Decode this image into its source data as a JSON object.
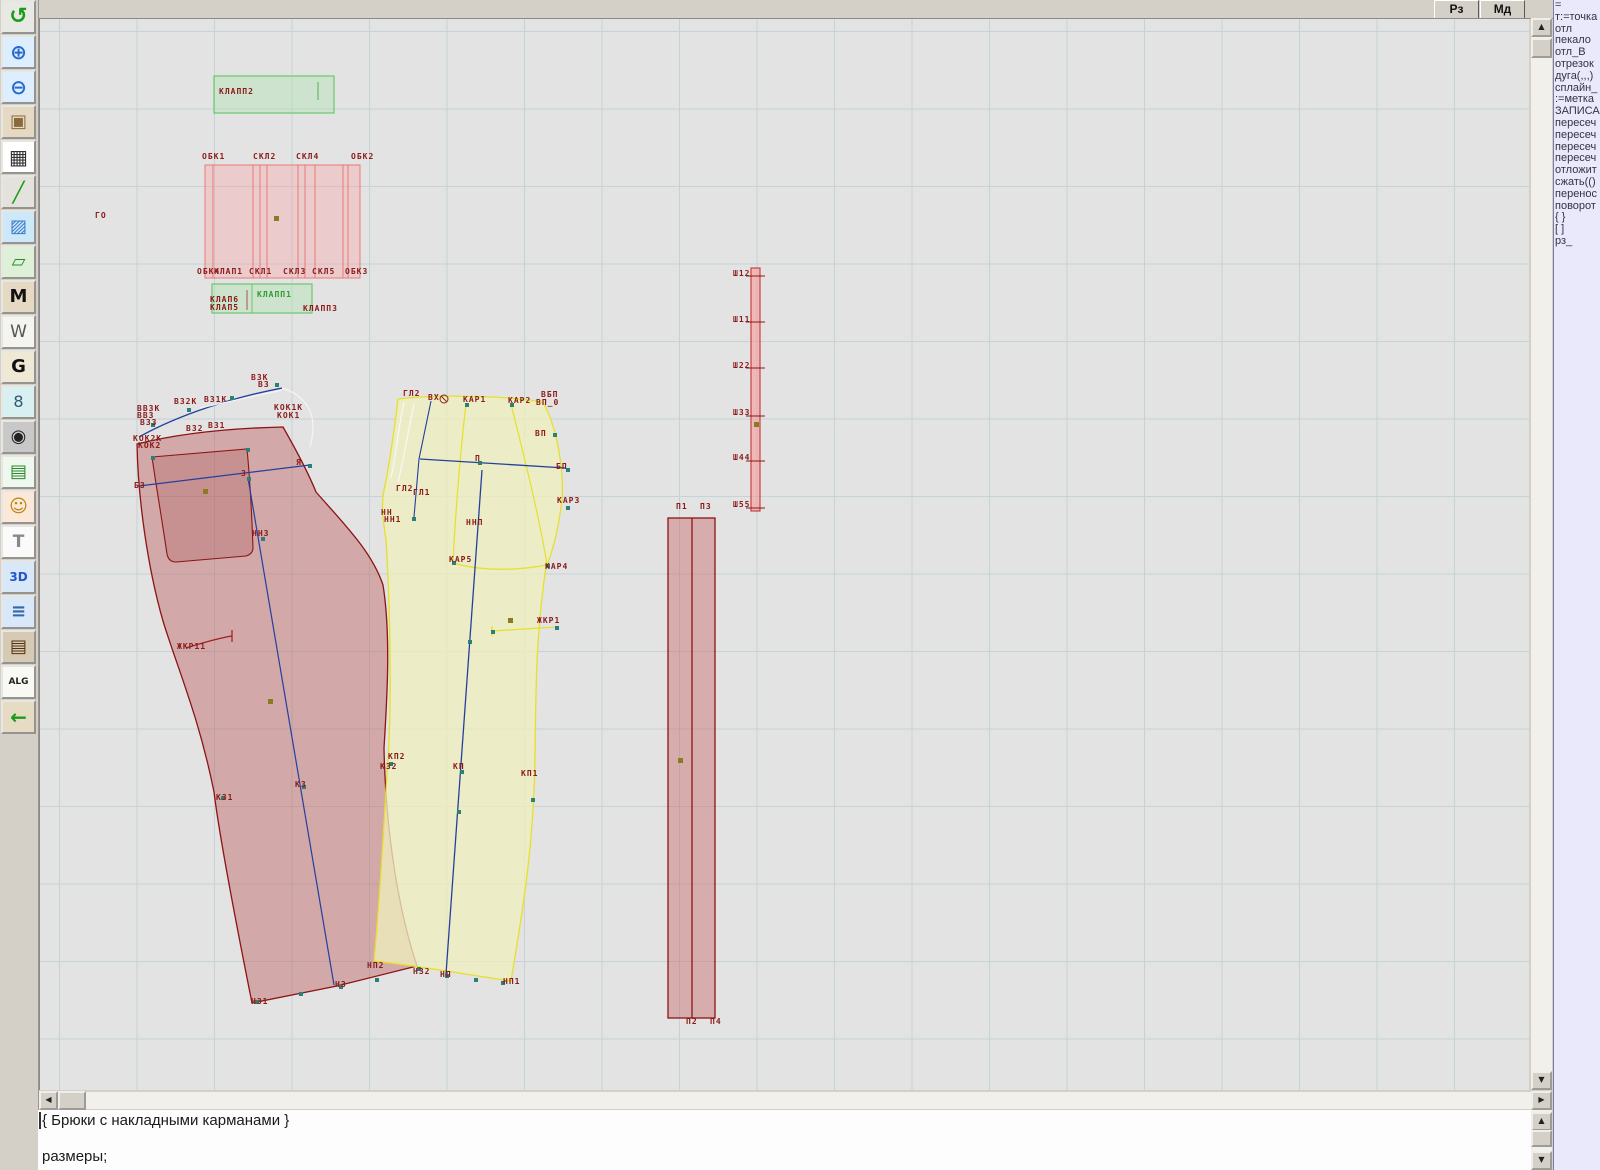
{
  "app": {
    "title": "Pattern CAD - Брюки с накладными карманами"
  },
  "topbar": {
    "buttons": [
      {
        "name": "mode-rz-button",
        "label": "Рз"
      },
      {
        "name": "mode-md-button",
        "label": "Мд"
      }
    ]
  },
  "toolbar": {
    "icons": [
      {
        "name": "reload-icon",
        "glyph": "↺",
        "color": "#1a9c1a",
        "bg": "#e8e8e4",
        "size": 22,
        "bold": true
      },
      {
        "name": "zoom-in-icon",
        "glyph": "⊕",
        "color": "#2a6acc",
        "bg": "#ddeeff",
        "size": 20,
        "bold": true
      },
      {
        "name": "zoom-out-icon",
        "glyph": "⊖",
        "color": "#2a6acc",
        "bg": "#ddeeff",
        "size": 20,
        "bold": true
      },
      {
        "name": "preview-piece-icon",
        "glyph": "▣",
        "color": "#8a6a3a",
        "bg": "#e6d9c3",
        "size": 18,
        "bold": false
      },
      {
        "name": "grid-icon",
        "glyph": "▦",
        "color": "#333333",
        "bg": "#ffffff",
        "size": 20,
        "bold": false
      },
      {
        "name": "measure-line-icon",
        "glyph": "╱",
        "color": "#1a9c1a",
        "bg": "#e4e2dc",
        "size": 20,
        "bold": true
      },
      {
        "name": "image-icon",
        "glyph": "▨",
        "color": "#3a7acc",
        "bg": "#cde8f8",
        "size": 18,
        "bold": false
      },
      {
        "name": "pattern-piece-icon",
        "glyph": "▱",
        "color": "#2a8a2a",
        "bg": "#dff0d8",
        "size": 18,
        "bold": false
      },
      {
        "name": "lekalo-m-icon",
        "glyph": "M",
        "color": "#111111",
        "bg": "#e6d9c3",
        "size": 18,
        "bold": true
      },
      {
        "name": "drafting-w-icon",
        "glyph": "W",
        "color": "#555555",
        "bg": "#f4f4f0",
        "size": 17,
        "bold": false
      },
      {
        "name": "grading-g-icon",
        "glyph": "G",
        "color": "#111111",
        "bg": "#efe8d4",
        "size": 18,
        "bold": true
      },
      {
        "name": "ruler-icon",
        "glyph": "8",
        "color": "#335577",
        "bg": "#d8f0f0",
        "size": 16,
        "bold": false
      },
      {
        "name": "camera-icon",
        "glyph": "◉",
        "color": "#222222",
        "bg": "#c8c8c8",
        "size": 18,
        "bold": false
      },
      {
        "name": "spreadsheet-icon",
        "glyph": "▤",
        "color": "#2a8a2a",
        "bg": "#eef8ee",
        "size": 18,
        "bold": false
      },
      {
        "name": "model-photo-icon",
        "glyph": "☺",
        "color": "#b8860b",
        "bg": "#fce8d8",
        "size": 18,
        "bold": false
      },
      {
        "name": "garment-icon",
        "glyph": "T",
        "color": "#888888",
        "bg": "#fafafa",
        "size": 17,
        "bold": true
      },
      {
        "name": "threed-icon",
        "glyph": "3D",
        "color": "#2255cc",
        "bg": "#d8e8f8",
        "size": 12,
        "bold": true
      },
      {
        "name": "command-list-icon",
        "glyph": "≡",
        "color": "#3366aa",
        "bg": "#d8e8f8",
        "size": 18,
        "bold": true
      },
      {
        "name": "books-icon",
        "glyph": "▤",
        "color": "#553311",
        "bg": "#d6cab4",
        "size": 18,
        "bold": false
      },
      {
        "name": "alg-icon",
        "glyph": "ALG",
        "color": "#222222",
        "bg": "#f8f8f4",
        "size": 9,
        "bold": true
      },
      {
        "name": "exit-icon",
        "glyph": "←",
        "color": "#1a9c1a",
        "bg": "#e6dcc4",
        "size": 20,
        "bold": true
      }
    ]
  },
  "scrollbar": {
    "up": "▲",
    "down": "▼",
    "left": "◀",
    "right": "▶"
  },
  "canvas": {
    "labels": [
      [
        "ГО",
        95,
        211
      ],
      [
        "КЛАПП2",
        219,
        87
      ],
      [
        "ОБК1",
        202,
        152
      ],
      [
        "СКЛ2",
        253,
        152
      ],
      [
        "СКЛ4",
        296,
        152
      ],
      [
        "ОБК2",
        351,
        152
      ],
      [
        "ОБК4",
        197,
        267
      ],
      [
        "КЛАП1",
        214,
        267
      ],
      [
        "СКЛ1",
        249,
        267
      ],
      [
        "СКЛ3",
        283,
        267
      ],
      [
        "СКЛ5",
        312,
        267
      ],
      [
        "ОБК3",
        345,
        267
      ],
      [
        "КЛАП6",
        210,
        295
      ],
      [
        "КЛАП5",
        210,
        303
      ],
      [
        "КЛАПП1",
        257,
        290,
        "g"
      ],
      [
        "КЛАПП3",
        303,
        304
      ],
      [
        "В3К",
        251,
        373
      ],
      [
        "В3",
        258,
        380
      ],
      [
        "ВЗ2К",
        174,
        397
      ],
      [
        "ВЗ1К",
        204,
        395
      ],
      [
        "ВВ3К",
        137,
        404
      ],
      [
        "ВВ3",
        137,
        411
      ],
      [
        "В33",
        140,
        418
      ],
      [
        "В32",
        186,
        424
      ],
      [
        "В31",
        208,
        421
      ],
      [
        "КОК1К",
        274,
        403
      ],
      [
        "КОК1",
        277,
        411
      ],
      [
        "КОК2К",
        133,
        434
      ],
      [
        "КОК2",
        138,
        441
      ],
      [
        "Б3",
        134,
        481
      ],
      [
        "З",
        241,
        469
      ],
      [
        "Я",
        296,
        458
      ],
      [
        "НН3",
        252,
        529
      ],
      [
        "ЖКР11",
        177,
        642
      ],
      [
        "К31",
        216,
        793
      ],
      [
        "К3",
        295,
        780
      ],
      [
        "КП2",
        388,
        752
      ],
      [
        "К32",
        380,
        762
      ],
      [
        "НП2",
        367,
        961
      ],
      [
        "Н32",
        413,
        967
      ],
      [
        "Н3",
        335,
        980
      ],
      [
        "Н31",
        251,
        997
      ],
      [
        "ГЛ2",
        403,
        389
      ],
      [
        "ВХ",
        428,
        393
      ],
      [
        "КАР1",
        463,
        395
      ],
      [
        "КАР2",
        508,
        396
      ],
      [
        "ВБП",
        541,
        390
      ],
      [
        "ВП_0",
        536,
        398
      ],
      [
        "ВП",
        535,
        429
      ],
      [
        "П",
        475,
        454
      ],
      [
        "БП",
        556,
        462
      ],
      [
        "ГЛ2",
        396,
        484
      ],
      [
        "ГЛ1",
        413,
        488
      ],
      [
        "НН",
        381,
        508
      ],
      [
        "НН1",
        384,
        515
      ],
      [
        "ННП",
        466,
        518
      ],
      [
        "КАР3",
        557,
        496
      ],
      [
        "КАР5",
        449,
        555
      ],
      [
        "КАР4",
        545,
        562
      ],
      [
        "ЖКР1",
        537,
        616
      ],
      [
        "КП",
        453,
        762
      ],
      [
        "КП1",
        521,
        769
      ],
      [
        "НП",
        440,
        970
      ],
      [
        "НП1",
        503,
        977
      ],
      [
        "П1",
        676,
        502
      ],
      [
        "П3",
        700,
        502
      ],
      [
        "П2",
        686,
        1017
      ],
      [
        "П4",
        710,
        1017
      ],
      [
        "Ш12",
        733,
        269
      ],
      [
        "Ш11",
        733,
        315
      ],
      [
        "Ш22",
        733,
        361
      ],
      [
        "Ш33",
        733,
        408
      ],
      [
        "Ш44",
        733,
        453
      ],
      [
        "Ш55",
        733,
        500
      ]
    ]
  },
  "right_panel": {
    "items": [
      "=",
      "т:=точка",
      "отл",
      "пекало",
      "отл_В",
      "отрезок",
      "дуга(,,,)",
      "сплайн_",
      ":=метка",
      "ЗАПИСА",
      "пересеч",
      "пересеч",
      "пересеч",
      "пересеч",
      "отложит",
      "сжать(()",
      "перенос",
      "поворот",
      "{  }",
      "[  ]",
      "рз_"
    ]
  },
  "status_text": {
    "line1": "{  Брюки с накладными карманами }",
    "line2": "размеры;"
  },
  "colors": {
    "back_piece_stroke": "#8b1414",
    "back_piece_fill": "rgba(188,95,95,0.45)",
    "front_piece_stroke": "#e6e02a",
    "front_piece_fill": "rgba(238,238,190,0.78)",
    "construction_blue": "#24409e",
    "label_red": "#8b1a1a",
    "label_green": "#2e9e2e",
    "pink_box": "#e87878",
    "green_box": "#6cc86c",
    "marker_teal": "#2d8077",
    "marker_olive": "#8a7a20"
  }
}
